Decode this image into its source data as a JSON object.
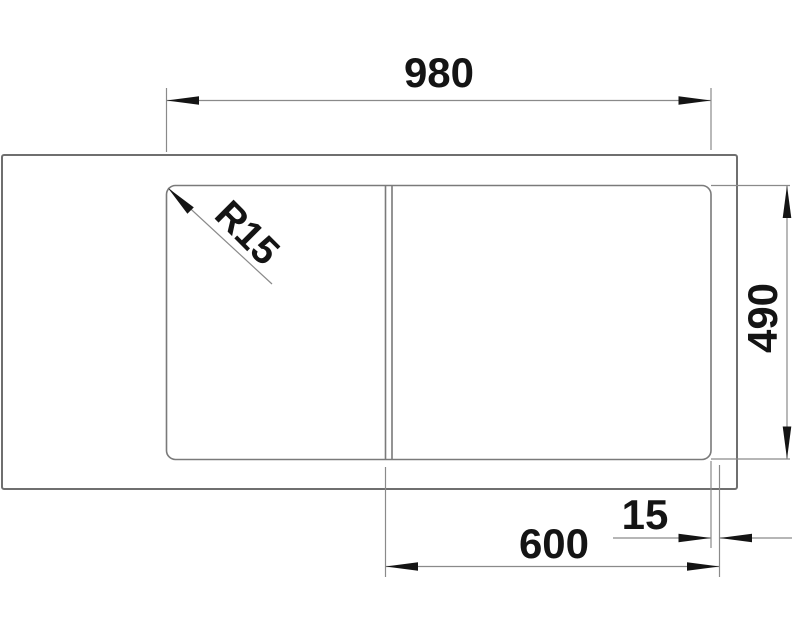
{
  "drawing": {
    "dimensions": {
      "overall_width": "980",
      "overall_depth": "490",
      "bowl_width": "600",
      "rim_offset": "15",
      "corner_radius": "R15"
    },
    "colors": {
      "outline": "#6f6f6f",
      "line": "#8a8a8a",
      "ink": "#141414",
      "background": "#ffffff"
    }
  }
}
